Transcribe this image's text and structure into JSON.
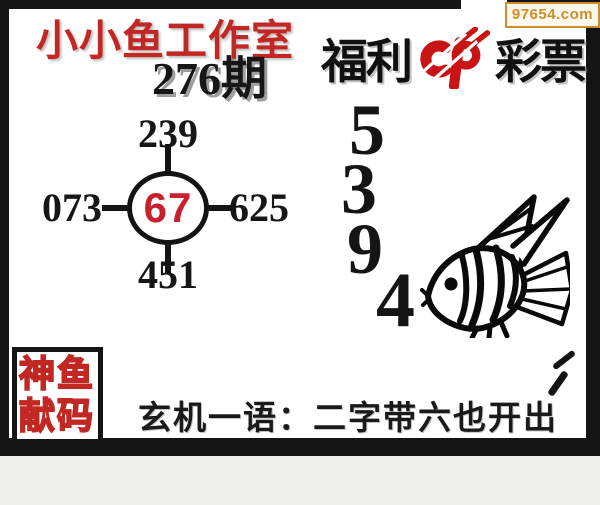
{
  "site_badge": {
    "url": "97654.com"
  },
  "header": {
    "studio_title": "小小鱼工作室",
    "issue_label": "276期",
    "brand": {
      "prefix": "福利",
      "suffix": "彩票"
    }
  },
  "number_wheel": {
    "center": "67",
    "top": "239",
    "left": "073",
    "right": "625",
    "bottom": "451"
  },
  "prediction_digits": [
    "5",
    "3",
    "9",
    "4"
  ],
  "stamp": {
    "line1": "神鱼",
    "line2": "献码"
  },
  "hint": {
    "label": "玄机一语：",
    "phrase": "二字带六也开出"
  },
  "icons": {
    "brand_logo": "cp-lottery-logo",
    "fish": "angelfish-line-art"
  },
  "colors": {
    "accent_red": "#c22823",
    "brand_red": "#c81414",
    "center_red": "#c8202c",
    "badge_orange": "#cf8c2a",
    "frame_black": "#141414"
  }
}
